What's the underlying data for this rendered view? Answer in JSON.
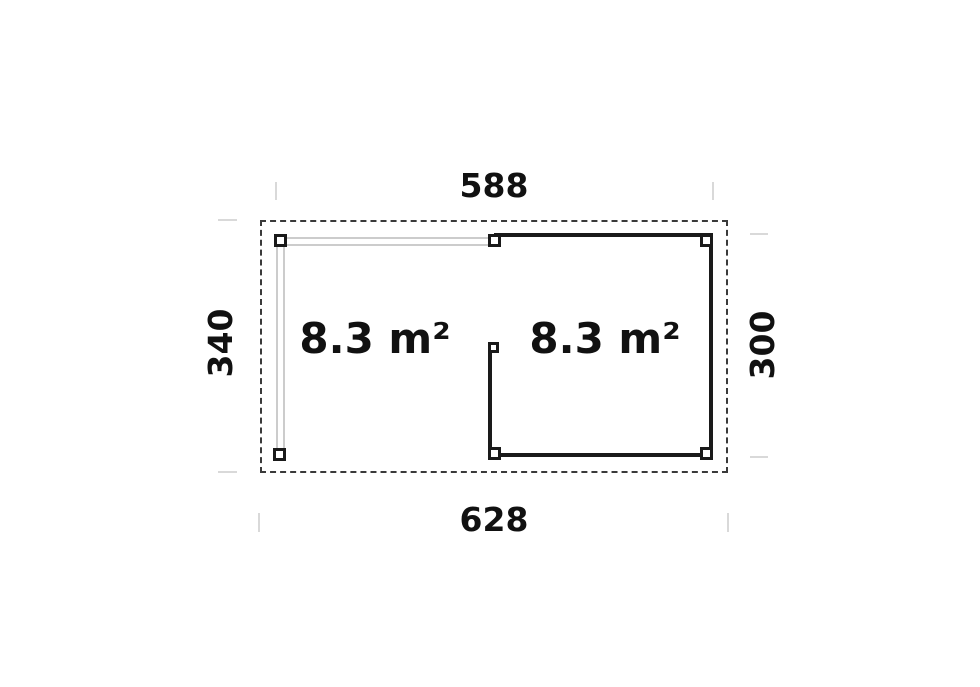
{
  "floor_plan": {
    "description": "Floor plan of a rectangular garden building with an open post-and-beam terrace on the left and an enclosed room on the right",
    "dimensions": {
      "top": "588",
      "bottom": "628",
      "left": "340",
      "right": "300"
    },
    "rooms": [
      {
        "id": "open-terrace",
        "area": "8.3 m²"
      },
      {
        "id": "enclosed-room",
        "area": "8.3 m²"
      }
    ],
    "colors": {
      "wall": "#1a1a1a",
      "roof_outline": "#3a3a3a",
      "beam": "#cccccc",
      "extension_line": "#d9d9d9",
      "text": "#111111",
      "background": "#ffffff"
    }
  }
}
